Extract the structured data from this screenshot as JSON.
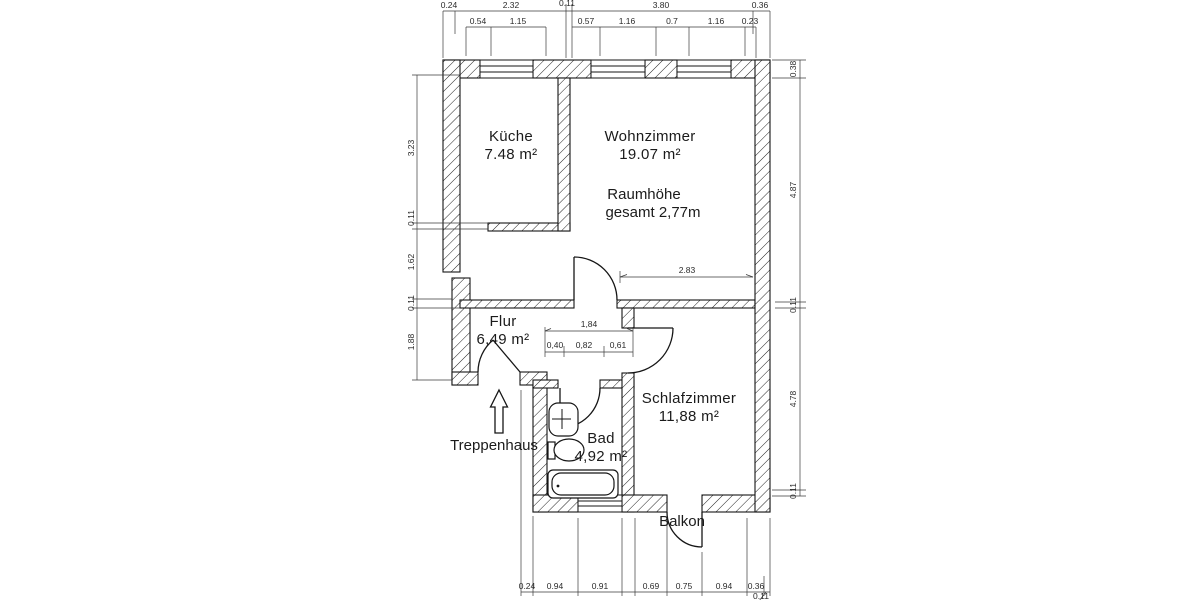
{
  "plan": {
    "rooms": [
      {
        "id": "kueche",
        "name": "Küche",
        "area": "7.48 m²",
        "x": 511,
        "y": 141,
        "ay": 159
      },
      {
        "id": "wohnzimmer",
        "name": "Wohnzimmer",
        "area": "19.07 m²",
        "x": 650,
        "y": 141,
        "ay": 159
      },
      {
        "id": "flur",
        "name": "Flur",
        "area": "6,49 m²",
        "x": 503,
        "y": 326,
        "ay": 344
      },
      {
        "id": "schlafzimmer",
        "name": "Schlafzimmer",
        "area": "11,88 m²",
        "x": 689,
        "y": 403,
        "ay": 421
      },
      {
        "id": "bad",
        "name": "Bad",
        "area": "4,92 m²",
        "x": 601,
        "y": 443,
        "ay": 461
      }
    ],
    "notes": [
      {
        "id": "raumhoehe-line1",
        "text": "Raumhöhe",
        "x": 644,
        "y": 199
      },
      {
        "id": "raumhoehe-line2",
        "text": "gesamt 2,77m",
        "x": 653,
        "y": 217
      },
      {
        "id": "treppenhaus",
        "text": "Treppenhaus",
        "x": 494,
        "y": 450
      },
      {
        "id": "balkon",
        "text": "Balkon",
        "x": 682,
        "y": 526
      }
    ],
    "dims": [
      {
        "t": "0.24",
        "x": 449,
        "y": 8
      },
      {
        "t": "2.32",
        "x": 511,
        "y": 8
      },
      {
        "t": "0.11",
        "x": 567,
        "y": 6
      },
      {
        "t": "3.80",
        "x": 661,
        "y": 8
      },
      {
        "t": "0.36",
        "x": 760,
        "y": 8
      },
      {
        "t": "0.54",
        "x": 478,
        "y": 24
      },
      {
        "t": "1.15",
        "x": 518,
        "y": 24
      },
      {
        "t": "0.57",
        "x": 586,
        "y": 24
      },
      {
        "t": "1.16",
        "x": 627,
        "y": 24
      },
      {
        "t": "0.7",
        "x": 672,
        "y": 24
      },
      {
        "t": "1.16",
        "x": 716,
        "y": 24
      },
      {
        "t": "0.23",
        "x": 750,
        "y": 24
      },
      {
        "t": "3.23",
        "x": 414,
        "y": 148,
        "r": -90
      },
      {
        "t": "0.11",
        "x": 414,
        "y": 218,
        "r": -90
      },
      {
        "t": "1.62",
        "x": 414,
        "y": 262,
        "r": -90
      },
      {
        "t": "0.11",
        "x": 414,
        "y": 303,
        "r": -90
      },
      {
        "t": "1.88",
        "x": 414,
        "y": 342,
        "r": -90
      },
      {
        "t": "0.38",
        "x": 796,
        "y": 69,
        "r": -90
      },
      {
        "t": "4.87",
        "x": 796,
        "y": 190,
        "r": -90
      },
      {
        "t": "0.11",
        "x": 796,
        "y": 305,
        "r": -90
      },
      {
        "t": "4.78",
        "x": 796,
        "y": 399,
        "r": -90
      },
      {
        "t": "0.11",
        "x": 796,
        "y": 491,
        "r": -90
      },
      {
        "t": "0.24",
        "x": 527,
        "y": 589
      },
      {
        "t": "0.94",
        "x": 555,
        "y": 589
      },
      {
        "t": "0.91",
        "x": 600,
        "y": 589
      },
      {
        "t": "0.69",
        "x": 651,
        "y": 589
      },
      {
        "t": "0.75",
        "x": 684,
        "y": 589
      },
      {
        "t": "0.94",
        "x": 724,
        "y": 589
      },
      {
        "t": "0.36",
        "x": 756,
        "y": 589
      },
      {
        "t": "0.11",
        "x": 761,
        "y": 599
      },
      {
        "t": "2.83",
        "x": 687,
        "y": 273
      },
      {
        "t": "1,84",
        "x": 589,
        "y": 327
      },
      {
        "t": "0,40",
        "x": 555,
        "y": 348
      },
      {
        "t": "0,82",
        "x": 584,
        "y": 348
      },
      {
        "t": "0,61",
        "x": 618,
        "y": 348
      }
    ]
  }
}
